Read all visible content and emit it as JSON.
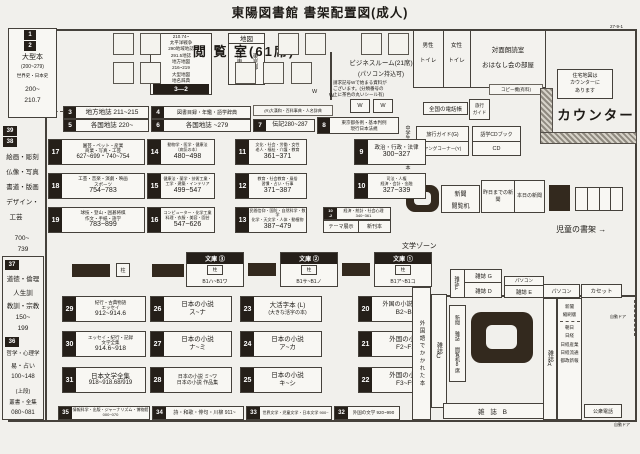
{
  "header": {
    "title": "東陽図書館 書架配置図(成人)",
    "page_ref": "27-9-1"
  },
  "reading_room": {
    "title": "閲 覧 室(61席)"
  },
  "sidebar": {
    "large_books": {
      "n1": "1",
      "n2": "2",
      "name": "大型本",
      "paren": "(200~279)",
      "sub": "世界史・日本史",
      "r1": "200~",
      "r2": "210.7"
    },
    "art": {
      "n1": "39",
      "n2": "38",
      "l1": "絵画・彫刻",
      "l2": "仏像・写真",
      "l3": "書道・版画",
      "l4": "デザイン・",
      "l5": "工芸",
      "r1": "700~",
      "r2": "739"
    },
    "ethics": {
      "n": "37",
      "l1": "道徳・倫理",
      "l2": "人生訓",
      "l3": "教訓・宗教",
      "r1": "150~",
      "r2": "199"
    },
    "philosophy": {
      "n": "36",
      "l1": "哲学・心理学",
      "l2": "易・占い",
      "l3": "100~148",
      "u1": "(上段)",
      "u2": "叢書・全集",
      "r": "080~081"
    }
  },
  "map_stack": {
    "l1": "210.74~",
    "l2": "太平洋戦争",
    "l3": "290地域地誌",
    "l4": "291.5地誌",
    "l5": "地方地図",
    "l6": "216~219",
    "l7": "大型地図",
    "l8": "地名辞典",
    "badge": "3—2"
  },
  "map_box": {
    "title": "地図",
    "c1": "江東区K",
    "c2": "東京都T"
  },
  "business_room": {
    "name": "ビジネスルーム(21席)",
    "sub": "(パソコン持込可)",
    "note1": "請求記号Wで始まる資料が",
    "note2": "ございます。(分類番号の",
    "note3": "上に茶色の丸いシール有)",
    "w": "W"
  },
  "rooms": {
    "male1": "男性",
    "male2": "トイレ",
    "female1": "女性",
    "female2": "トイレ",
    "service1": "対面朗読室",
    "service2": "おはなし会の部屋",
    "copier": "コピー機(有料)"
  },
  "counter": {
    "label": "カウンター",
    "housing1": "住宅地図は",
    "housing2": "カウンターに",
    "housing3": "あります",
    "phonebook": "全国の電話帳",
    "travel_mini1": "旅行",
    "travel_mini2": "ガイド",
    "travel_guide": "旅行ガイド(G)",
    "young_corner": "ヤングコーナー(Y)",
    "cd_book": "語学CDブック",
    "cd": "CD",
    "jhs": "中学生にすすめる本",
    "news_desk1": "新聞",
    "news_desk2": "閲覧机",
    "yesterday": "昨日までの新聞",
    "today": "本日の新聞",
    "children": "児童の書架",
    "arrow": "→"
  },
  "shelves": {
    "s3": {
      "n": "3",
      "t": "地方地誌 211~215"
    },
    "s4": {
      "n": "4",
      "t": "図書目録・年鑑・語学辞典"
    },
    "s5": {
      "n": "5",
      "t": "各国地誌 220~"
    },
    "s6": {
      "n": "6",
      "t": "各国地誌 ~279"
    },
    "s7": {
      "n": "7",
      "t": "伝記280~287"
    },
    "s8": {
      "n": "8",
      "t1": "東京都条例・基本判例",
      "t2": "現行日本法規"
    },
    "rdict": "(R)大漢和・百科事典・人名辞典",
    "s9": {
      "n": "9",
      "t1": "政治・行政・法律",
      "r": "300~327"
    },
    "s10": {
      "n": "10",
      "t1": "司法・人権",
      "t2": "経済・会計・金融",
      "r": "327~339"
    },
    "s10b": {
      "n1": "10",
      "n2": "-2",
      "t1": "経済・統計・社会心理",
      "r": "340~361"
    },
    "theme": "テーマ展示",
    "new_books": "新刊本",
    "s11": {
      "n": "11",
      "t1": "文化・社会・労働・女性",
      "t2": "老人・福祉・介護・教育",
      "r": "361~371"
    },
    "s12": {
      "n": "12",
      "t1": "教育・社会教育・風俗",
      "t2": "習慣・占い・行事",
      "r": "371~387"
    },
    "s13": {
      "n": "13",
      "t1": "民間信仰・国防・自然科学・数学",
      "t2": "化学・天文学・人体・動植物",
      "r": "387~479"
    },
    "s14": {
      "n": "14",
      "t1": "動物学・医学・健康法",
      "t2": "〔病気の本〕",
      "r": "480~498"
    },
    "s15": {
      "n": "15",
      "t1": "健康法・薬学・技術工業・",
      "t2": "工学・建築・インテリア",
      "r": "499~547"
    },
    "s16": {
      "n": "16",
      "t1": "コンピューター・化学工業",
      "t2": "料理・衣服・美容・園芸",
      "r": "547~626"
    },
    "s17": {
      "n": "17",
      "t1": "園芸・ペット・産業",
      "t2": "商業・写真・工芸",
      "r": "627~699・740~754"
    },
    "s18": {
      "n": "18",
      "t1": "工芸・音楽・演劇・映画",
      "t2": "スポーツ",
      "r": "754~783"
    },
    "s19": {
      "n": "19",
      "t1": "球技・登山・囲碁将棋",
      "t2": "作文・手紙・語学",
      "r": "783~899"
    },
    "s20": {
      "n": "20",
      "t1": "外国の小説(文庫)",
      "r": "B2~B8"
    },
    "s21": {
      "n": "21",
      "t1": "外国の小説",
      "r": "F2~F3"
    },
    "s22": {
      "n": "22",
      "t1": "外国の小説",
      "r": "F3~F9"
    },
    "s23": {
      "n": "23",
      "t1": "大活字本 (L)",
      "t2": "(大きな活字の本)"
    },
    "s24": {
      "n": "24",
      "t1": "日本の小説",
      "r": "ア~カ"
    },
    "s25": {
      "n": "25",
      "t1": "日本の小説",
      "r": "キ~シ"
    },
    "s26": {
      "n": "26",
      "t1": "日本の小説",
      "r": "ス~ナ"
    },
    "s27": {
      "n": "27",
      "t1": "日本の小説",
      "r": "ナ~ミ"
    },
    "s28": {
      "n": "28",
      "t1": "日本の小説 ミ~ワ",
      "t2": "日本の小説 作品集"
    },
    "s29": {
      "n": "29",
      "t1": "紀行・古典物語",
      "t2": "エッセイ",
      "r": "912~914.6"
    },
    "s30": {
      "n": "30",
      "t1": "エッセイ・紀行・記録",
      "t2": "文学全集",
      "r": "914.6~918"
    },
    "s31": {
      "n": "31",
      "t1": "日本文学全集",
      "r": "918~918.68/919"
    },
    "s32": {
      "n": "32",
      "t": "外国の文学 920~990"
    },
    "s33": {
      "n": "33",
      "t": "世界文学・児童文学・日本文学 900~"
    },
    "s34": {
      "n": "34",
      "t": "詩・和歌・俳句・川柳 911~"
    },
    "s35": {
      "n": "35",
      "t": "情報科学・出版・ジャーナリズム・博物館 000~070"
    }
  },
  "bunko": {
    "b3": {
      "title": "文庫 ③",
      "pillar": "柱",
      "range": "B1ハ~B1ワ"
    },
    "b2": {
      "title": "文庫 ②",
      "pillar": "柱",
      "range": "B1サ~B1ノ"
    },
    "b1": {
      "title": "文庫 ①",
      "pillar": "柱",
      "range": "B1ア~B1コ"
    },
    "pillar": "柱"
  },
  "literature_zone": "文学ゾーン",
  "magazines": {
    "foreign": "外国語でかかれた本",
    "a": "雑誌A",
    "b": "雑 誌 B",
    "c": "雑誌C",
    "d": "雑誌 D",
    "e": "雑誌 E",
    "f": "雑誌F",
    "g": "雑誌 G",
    "pc1": "パソコン",
    "pc2": "パソコン",
    "cassette": "カセット",
    "rack": "新聞 雑誌 閲覧机8席",
    "news1": "新聞",
    "news2": "縮刷版",
    "p1": "朝日",
    "p2": "日経",
    "p3": "日経産業",
    "p4": "日経流通",
    "p5": "都政新報",
    "payphone": "公衆電話",
    "autodoor": "自動ドア"
  }
}
